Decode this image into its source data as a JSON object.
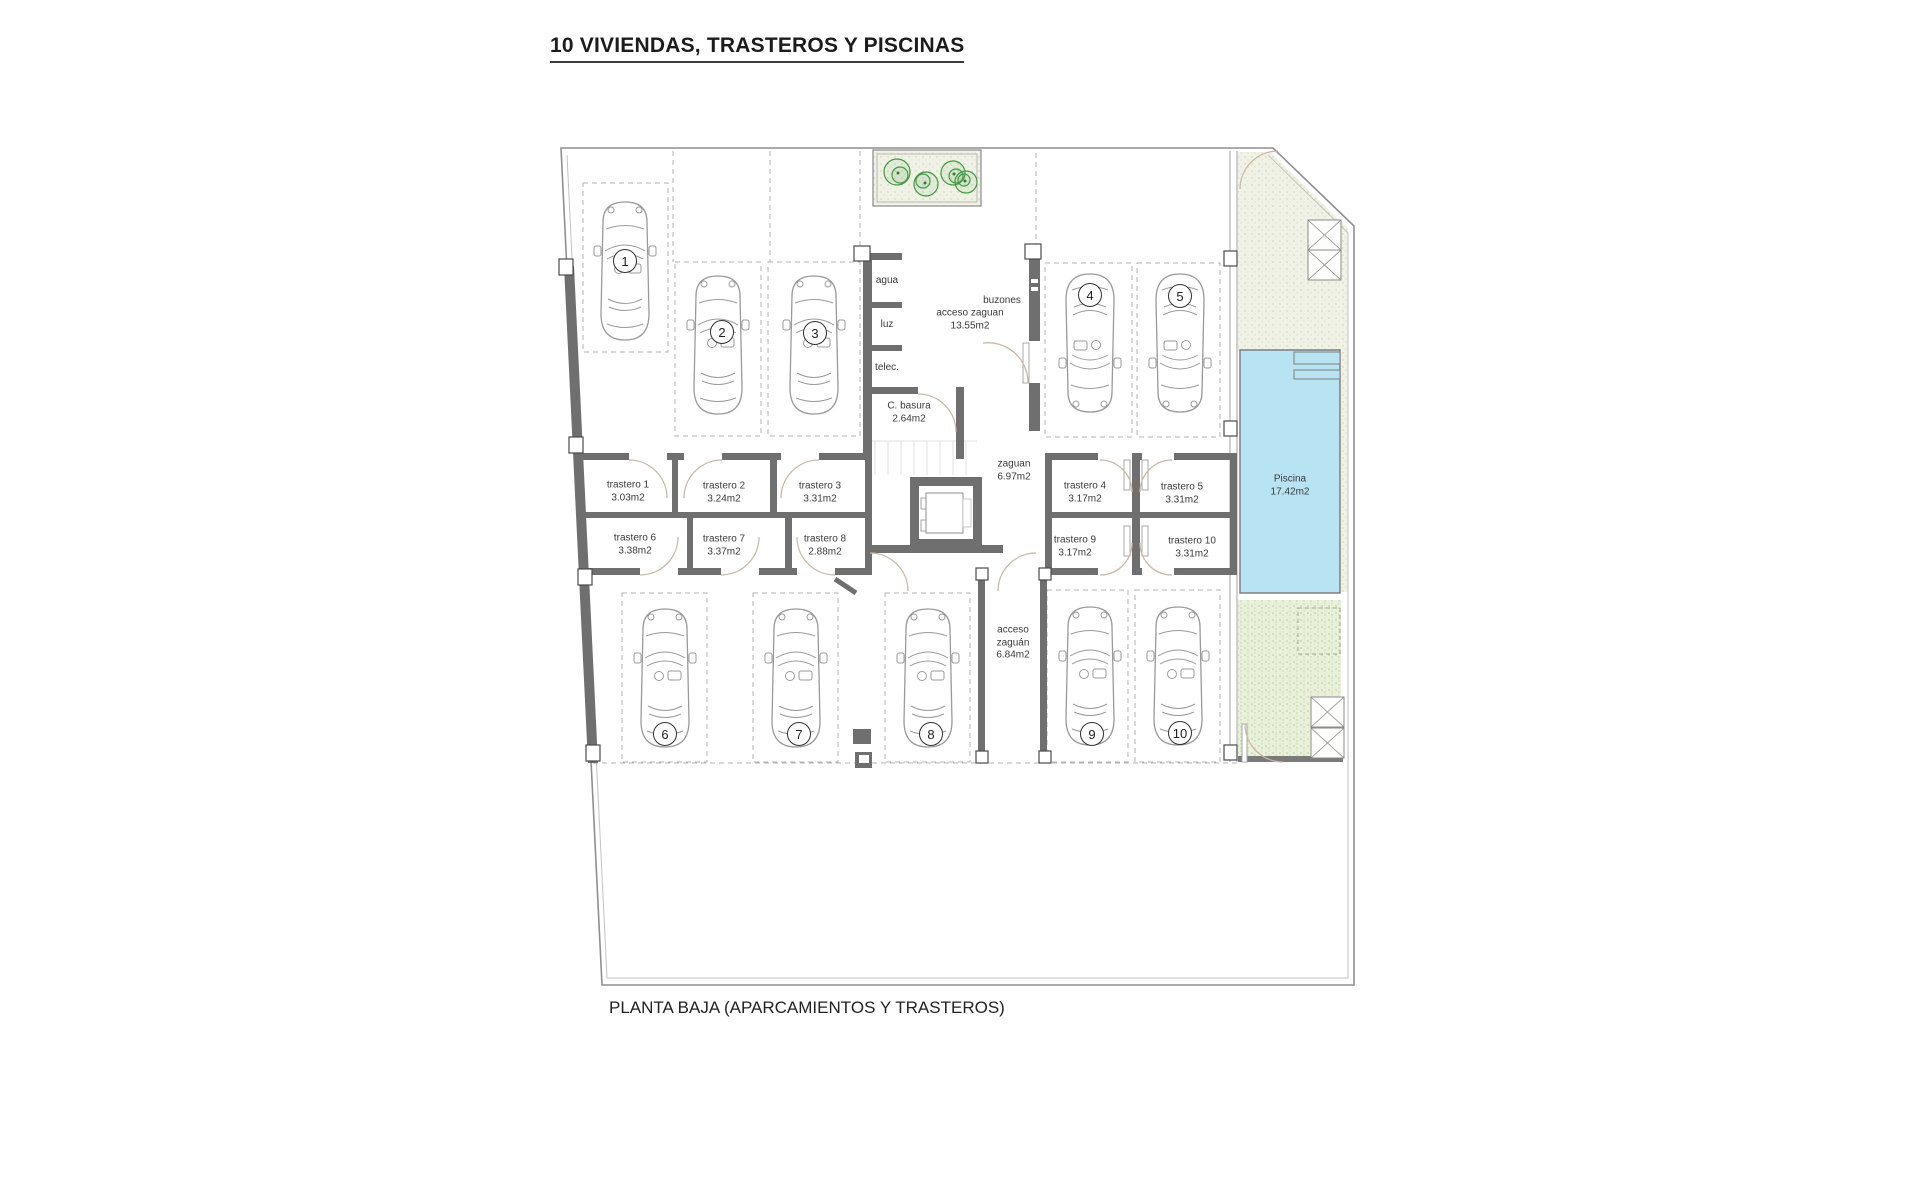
{
  "title": "10 VIVIENDAS, TRASTEROS Y PISCINAS",
  "caption": "PLANTA BAJA (APARCAMIENTOS Y TRASTEROS)",
  "parking_spots": [
    {
      "label": "1"
    },
    {
      "label": "2"
    },
    {
      "label": "3"
    },
    {
      "label": "4"
    },
    {
      "label": "5"
    },
    {
      "label": "6"
    },
    {
      "label": "7"
    },
    {
      "label": "8"
    },
    {
      "label": "9"
    },
    {
      "label": "10"
    }
  ],
  "trasteros": [
    {
      "name": "trastero 1",
      "area": "3.03m2"
    },
    {
      "name": "trastero 2",
      "area": "3.24m2"
    },
    {
      "name": "trastero 3",
      "area": "3.31m2"
    },
    {
      "name": "trastero 4",
      "area": "3.17m2"
    },
    {
      "name": "trastero 5",
      "area": "3.31m2"
    },
    {
      "name": "trastero 6",
      "area": "3.38m2"
    },
    {
      "name": "trastero 7",
      "area": "3.37m2"
    },
    {
      "name": "trastero 8",
      "area": "2.88m2"
    },
    {
      "name": "trastero 9",
      "area": "3.17m2"
    },
    {
      "name": "trastero 10",
      "area": "3.31m2"
    }
  ],
  "rooms": {
    "agua": {
      "name": "agua"
    },
    "luz": {
      "name": "luz"
    },
    "telec": {
      "name": "telec."
    },
    "basura": {
      "name": "C. basura",
      "area": "2.64m2"
    },
    "acceso_zaguan": {
      "name": "acceso zaguan",
      "area": "13.55m2"
    },
    "buzones": {
      "name": "buzones"
    },
    "zaguan": {
      "name": "zaguan",
      "area": "6.97m2"
    },
    "acceso_zaguan_sur": {
      "line1": "acceso",
      "line2": "zaguán",
      "area": "6.84m2"
    },
    "piscina": {
      "name": "Piscina",
      "area": "17.42m2"
    }
  },
  "colors": {
    "pool": "#b7e3f2",
    "wall": "#6f6f6f",
    "plant": "#3f9b40",
    "garden_top": "#f1f2e6",
    "garden_bottom": "#eaf1da"
  }
}
